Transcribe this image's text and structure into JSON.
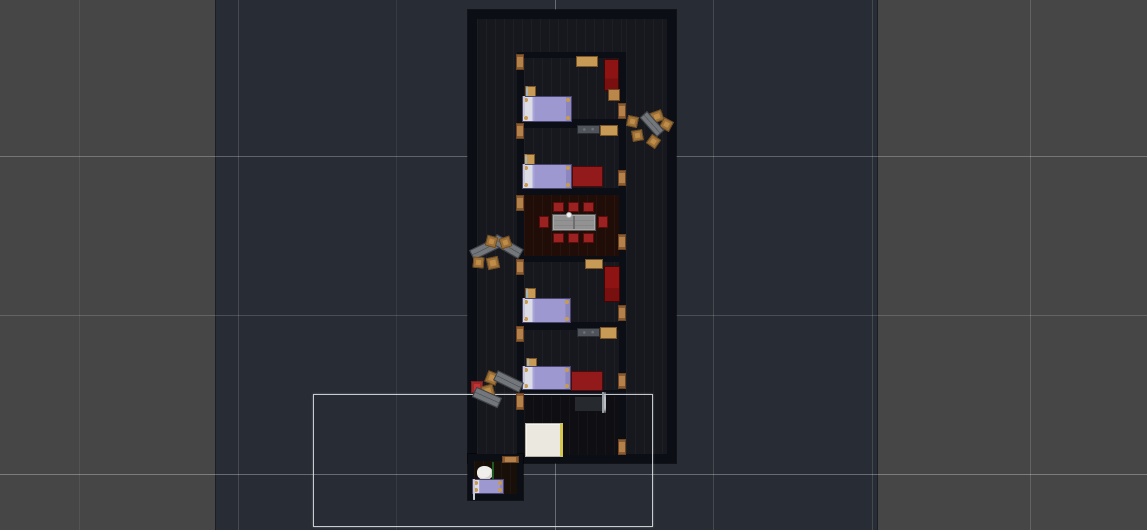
{
  "scene": {
    "viewport": {
      "w": 1147,
      "h": 530,
      "bg": "#282c34"
    },
    "regions": [
      {
        "name": "map-edge-left",
        "x": 0,
        "y": 0,
        "w": 215,
        "h": 530,
        "fill": "#464646"
      },
      {
        "name": "map-edge-right",
        "x": 878,
        "y": 0,
        "w": 269,
        "h": 530,
        "fill": "#464646"
      }
    ],
    "region_edges": [
      {
        "x": 215
      },
      {
        "x": 877
      }
    ],
    "grid": {
      "v": [
        {
          "x": 79,
          "o": 0.07
        },
        {
          "x": 238,
          "o": 0.14
        },
        {
          "x": 396,
          "o": 0.07
        },
        {
          "x": 555,
          "o": 0.3
        },
        {
          "x": 713,
          "o": 0.14
        },
        {
          "x": 872,
          "o": 0.14
        },
        {
          "x": 1030,
          "o": 0.16
        }
      ],
      "h": [
        {
          "y": 156,
          "o": 0.26
        },
        {
          "y": 315,
          "o": 0.16
        },
        {
          "y": 474,
          "o": 0.3
        }
      ]
    },
    "walls": [
      {
        "name": "main-building-walls",
        "x": 468,
        "y": 10,
        "w": 208,
        "h": 453,
        "fill": "#0c0e15"
      },
      {
        "name": "annex-walls",
        "x": 468,
        "y": 454,
        "w": 55,
        "h": 46,
        "fill": "#0c0e15"
      }
    ],
    "floors": [
      {
        "name": "hall-top",
        "x": 477,
        "y": 19,
        "w": 190,
        "h": 33,
        "fill": "#17181d"
      },
      {
        "name": "corridor-left",
        "x": 477,
        "y": 19,
        "w": 40,
        "h": 435,
        "fill": "#17181d"
      },
      {
        "name": "corridor-right",
        "x": 626,
        "y": 19,
        "w": 41,
        "h": 435,
        "fill": "#17181d"
      },
      {
        "name": "bedroom-1",
        "x": 524,
        "y": 58,
        "w": 95,
        "h": 61,
        "fill": "#17181d"
      },
      {
        "name": "bedroom-2",
        "x": 524,
        "y": 128,
        "w": 95,
        "h": 60,
        "fill": "#17181d"
      },
      {
        "name": "dining-room",
        "x": 524,
        "y": 195,
        "w": 95,
        "h": 61,
        "fill": "#200d07"
      },
      {
        "name": "bedroom-3",
        "x": 524,
        "y": 262,
        "w": 95,
        "h": 60,
        "fill": "#17181d"
      },
      {
        "name": "bedroom-4",
        "x": 524,
        "y": 330,
        "w": 95,
        "h": 60,
        "fill": "#17181d"
      },
      {
        "name": "bathroom",
        "x": 524,
        "y": 396,
        "w": 95,
        "h": 59,
        "fill": "#0f0f13"
      },
      {
        "name": "annex-room",
        "x": 474,
        "y": 461,
        "w": 43,
        "h": 33,
        "fill": "#170f08"
      }
    ],
    "zone": {
      "name": "zone-rectangle",
      "x": 313,
      "y": 394,
      "w": 340,
      "h": 133
    },
    "items": [
      {
        "type": "bucket",
        "x": 637,
        "y": 19,
        "w": 18,
        "h": 22
      },
      {
        "type": "door-v",
        "x": 516,
        "y": 54,
        "w": 8,
        "h": 16
      },
      {
        "type": "shelf-tan",
        "x": 576,
        "y": 56,
        "w": 22,
        "h": 11
      },
      {
        "type": "wardrobe-red",
        "x": 604,
        "y": 59,
        "w": 15,
        "h": 32
      },
      {
        "type": "nightstand",
        "x": 608,
        "y": 89,
        "w": 12,
        "h": 12
      },
      {
        "type": "medallion",
        "x": 525,
        "y": 86,
        "w": 11,
        "h": 11
      },
      {
        "type": "bed",
        "x": 522,
        "y": 96,
        "w": 50,
        "h": 26
      },
      {
        "type": "door-v",
        "x": 618,
        "y": 103,
        "w": 8,
        "h": 16
      },
      {
        "type": "stool",
        "x": 627,
        "y": 116,
        "w": 11,
        "h": 11,
        "r": 12
      },
      {
        "type": "stool",
        "x": 651,
        "y": 111,
        "w": 12,
        "h": 11,
        "r": -20
      },
      {
        "type": "stool",
        "x": 661,
        "y": 119,
        "w": 11,
        "h": 11,
        "r": 28
      },
      {
        "type": "bench",
        "x": 639,
        "y": 119,
        "w": 26,
        "h": 10,
        "r": 48
      },
      {
        "type": "stool",
        "x": 632,
        "y": 130,
        "w": 11,
        "h": 11,
        "r": -10
      },
      {
        "type": "stool",
        "x": 648,
        "y": 136,
        "w": 11,
        "h": 11,
        "r": 35
      },
      {
        "type": "door-v",
        "x": 516,
        "y": 123,
        "w": 8,
        "h": 16
      },
      {
        "type": "shelf-gray",
        "x": 577,
        "y": 125,
        "w": 23,
        "h": 9
      },
      {
        "type": "shelf-tan",
        "x": 600,
        "y": 125,
        "w": 18,
        "h": 11
      },
      {
        "type": "medallion",
        "x": 524,
        "y": 154,
        "w": 11,
        "h": 11
      },
      {
        "type": "bed",
        "x": 522,
        "y": 164,
        "w": 50,
        "h": 25
      },
      {
        "type": "couch-red",
        "x": 572,
        "y": 166,
        "w": 31,
        "h": 21
      },
      {
        "type": "door-v",
        "x": 618,
        "y": 170,
        "w": 8,
        "h": 16
      },
      {
        "type": "bucket",
        "x": 487,
        "y": 214,
        "w": 18,
        "h": 23
      },
      {
        "type": "door-v",
        "x": 516,
        "y": 195,
        "w": 8,
        "h": 16
      },
      {
        "type": "chair-red",
        "x": 553,
        "y": 202,
        "w": 11,
        "h": 10
      },
      {
        "type": "chair-red",
        "x": 568,
        "y": 202,
        "w": 11,
        "h": 10
      },
      {
        "type": "chair-red",
        "x": 583,
        "y": 202,
        "w": 11,
        "h": 10
      },
      {
        "type": "chair-red",
        "x": 539,
        "y": 216,
        "w": 10,
        "h": 12
      },
      {
        "type": "table-stone",
        "x": 552,
        "y": 214,
        "w": 44,
        "h": 17
      },
      {
        "type": "cup",
        "x": 566,
        "y": 212,
        "w": 6,
        "h": 6
      },
      {
        "type": "chair-red",
        "x": 598,
        "y": 216,
        "w": 10,
        "h": 12
      },
      {
        "type": "chair-red",
        "x": 553,
        "y": 233,
        "w": 11,
        "h": 10
      },
      {
        "type": "chair-red",
        "x": 568,
        "y": 233,
        "w": 11,
        "h": 10
      },
      {
        "type": "chair-red",
        "x": 583,
        "y": 233,
        "w": 11,
        "h": 10
      },
      {
        "type": "door-v",
        "x": 618,
        "y": 234,
        "w": 8,
        "h": 16
      },
      {
        "type": "bench",
        "x": 470,
        "y": 243,
        "w": 31,
        "h": 11,
        "r": -26
      },
      {
        "type": "bench",
        "x": 492,
        "y": 241,
        "w": 31,
        "h": 11,
        "r": 30
      },
      {
        "type": "stool",
        "x": 486,
        "y": 236,
        "w": 11,
        "h": 11,
        "r": 15
      },
      {
        "type": "stool",
        "x": 500,
        "y": 237,
        "w": 11,
        "h": 11,
        "r": -18
      },
      {
        "type": "stool",
        "x": 473,
        "y": 257,
        "w": 11,
        "h": 11,
        "r": 5
      },
      {
        "type": "stool",
        "x": 487,
        "y": 257,
        "w": 12,
        "h": 12,
        "r": -12
      },
      {
        "type": "bucket",
        "x": 486,
        "y": 289,
        "w": 19,
        "h": 23
      },
      {
        "type": "door-v",
        "x": 516,
        "y": 259,
        "w": 8,
        "h": 16
      },
      {
        "type": "shelf-tan",
        "x": 585,
        "y": 259,
        "w": 18,
        "h": 10
      },
      {
        "type": "wardrobe-red",
        "x": 604,
        "y": 266,
        "w": 16,
        "h": 36
      },
      {
        "type": "medallion",
        "x": 525,
        "y": 288,
        "w": 11,
        "h": 11
      },
      {
        "type": "bed",
        "x": 522,
        "y": 298,
        "w": 49,
        "h": 25
      },
      {
        "type": "door-v",
        "x": 618,
        "y": 305,
        "w": 8,
        "h": 16
      },
      {
        "type": "door-v",
        "x": 516,
        "y": 326,
        "w": 8,
        "h": 16
      },
      {
        "type": "shelf-gray",
        "x": 577,
        "y": 328,
        "w": 23,
        "h": 9
      },
      {
        "type": "shelf-tan",
        "x": 600,
        "y": 327,
        "w": 17,
        "h": 12
      },
      {
        "type": "medallion",
        "x": 526,
        "y": 358,
        "w": 11,
        "h": 11
      },
      {
        "type": "bed",
        "x": 522,
        "y": 366,
        "w": 49,
        "h": 24
      },
      {
        "type": "couch-red",
        "x": 571,
        "y": 371,
        "w": 32,
        "h": 20
      },
      {
        "type": "door-v",
        "x": 618,
        "y": 373,
        "w": 8,
        "h": 16
      },
      {
        "type": "box-red",
        "x": 471,
        "y": 381,
        "w": 12,
        "h": 12
      },
      {
        "type": "stool",
        "x": 486,
        "y": 372,
        "w": 12,
        "h": 12,
        "r": 22
      },
      {
        "type": "stool",
        "x": 482,
        "y": 385,
        "w": 12,
        "h": 12,
        "r": -15
      },
      {
        "type": "bench",
        "x": 494,
        "y": 376,
        "w": 29,
        "h": 11,
        "r": 26
      },
      {
        "type": "bench",
        "x": 473,
        "y": 392,
        "w": 28,
        "h": 11,
        "r": 24
      },
      {
        "type": "door-v",
        "x": 516,
        "y": 393,
        "w": 8,
        "h": 17
      },
      {
        "type": "counter",
        "x": 574,
        "y": 396,
        "w": 29,
        "h": 16
      },
      {
        "type": "toilet",
        "x": 602,
        "y": 393,
        "w": 17,
        "h": 25
      },
      {
        "type": "shower",
        "x": 525,
        "y": 423,
        "w": 38,
        "h": 34
      },
      {
        "type": "door-v",
        "x": 618,
        "y": 439,
        "w": 8,
        "h": 16
      },
      {
        "type": "door-h",
        "x": 502,
        "y": 456,
        "w": 17,
        "h": 7
      },
      {
        "type": "bundle",
        "x": 477,
        "y": 466,
        "w": 16,
        "h": 14
      },
      {
        "type": "person",
        "x": 492,
        "y": 463,
        "w": 15,
        "h": 20
      },
      {
        "type": "bed",
        "x": 472,
        "y": 479,
        "w": 32,
        "h": 15
      }
    ]
  }
}
